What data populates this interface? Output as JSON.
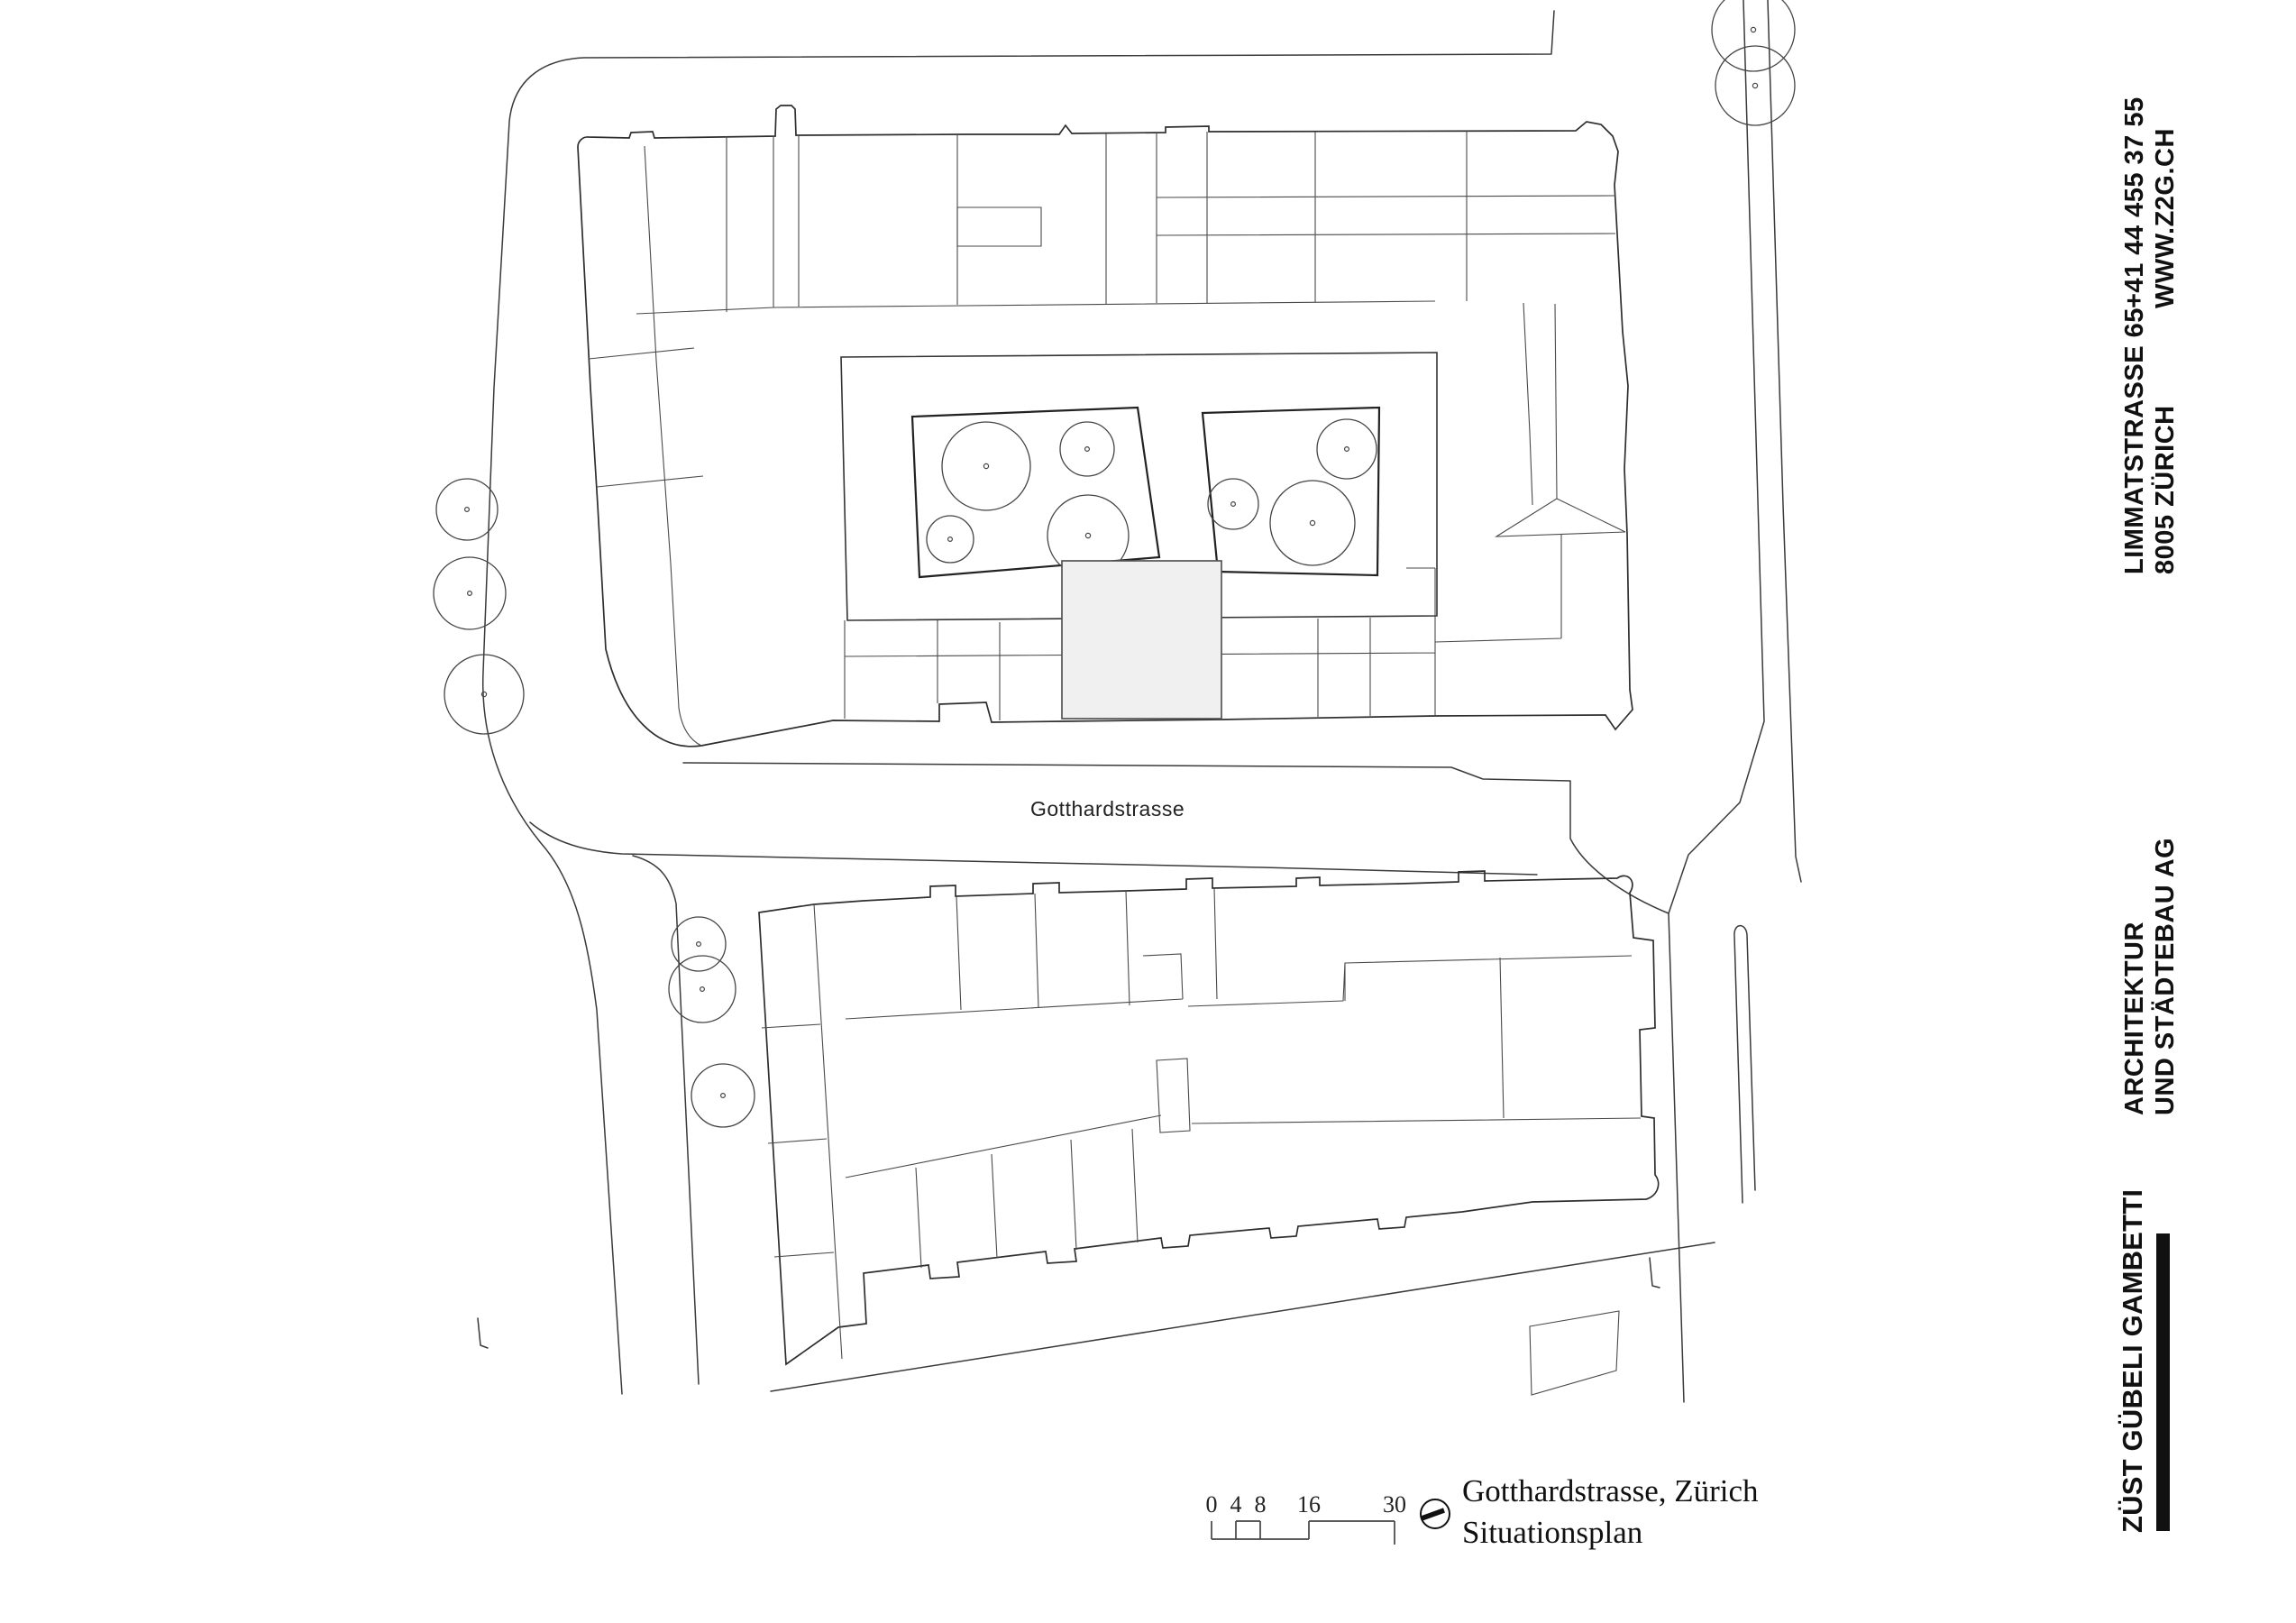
{
  "plan": {
    "street_label": "Gotthardstrasse",
    "title_line1": "Gotthardstrasse, Zürich",
    "title_line2": "Situationsplan",
    "scale_bar": {
      "labels": [
        "0",
        "4",
        "8",
        "16",
        "30"
      ]
    }
  },
  "firm": {
    "phone": "+41 44 455 37 55",
    "website": "WWW.Z2G.CH",
    "address_line1": "LIMMATSTRASSE 65",
    "address_line2": "8005 ZÜRICH",
    "discipline_line1": "ARCHITEKTUR",
    "discipline_line2": "UND STÄDTEBAU AG",
    "name": "ZÜST GÜBELI GAMBETTI"
  },
  "colors": {
    "line": "#3a3a3a",
    "highlight_fill": "#f0f0f0",
    "text": "#111111"
  }
}
